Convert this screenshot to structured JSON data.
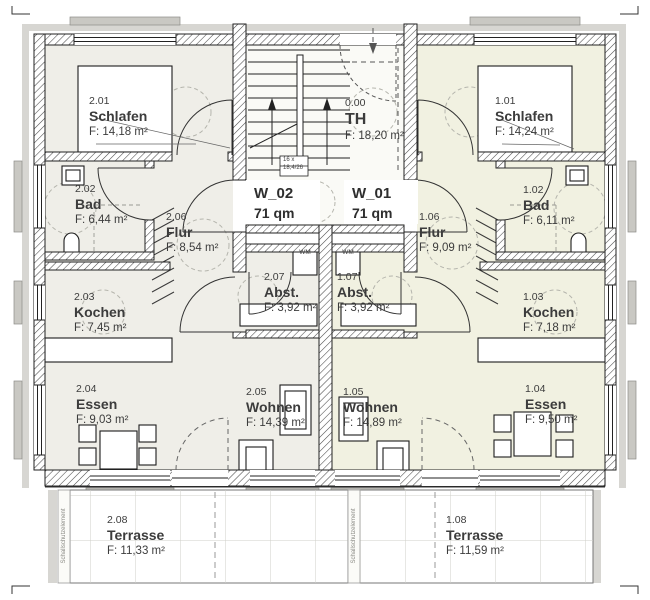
{
  "plan_type": "floor-plan",
  "apartments": {
    "w02": {
      "name": "W_02",
      "size": "71 qm"
    },
    "w01": {
      "name": "W_01",
      "size": "71 qm"
    }
  },
  "stairwell": {
    "number": "0.00",
    "name": "TH",
    "area": "F: 18,20 m²",
    "note1": "16 x",
    "note2": "18,4/26"
  },
  "rooms": {
    "r201": {
      "number": "2.01",
      "name": "Schlafen",
      "area": "F: 14,18 m²"
    },
    "r202": {
      "number": "2.02",
      "name": "Bad",
      "area": "F: 6,44 m²"
    },
    "r203": {
      "number": "2.03",
      "name": "Kochen",
      "area": "F: 7,45 m²"
    },
    "r204": {
      "number": "2.04",
      "name": "Essen",
      "area": "F: 9,03 m²"
    },
    "r205": {
      "number": "2.05",
      "name": "Wohnen",
      "area": "F: 14,39 m²"
    },
    "r206": {
      "number": "2.06",
      "name": "Flur",
      "area": "F: 8,54 m²"
    },
    "r207": {
      "number": "2.07",
      "name": "Abst.",
      "area": "F: 3,92 m²"
    },
    "r208": {
      "number": "2.08",
      "name": "Terrasse",
      "area": "F: 11,33 m²"
    },
    "r101": {
      "number": "1.01",
      "name": "Schlafen",
      "area": "F: 14,24 m²"
    },
    "r102": {
      "number": "1.02",
      "name": "Bad",
      "area": "F: 6,11 m²"
    },
    "r103": {
      "number": "1.03",
      "name": "Kochen",
      "area": "F: 7,18 m²"
    },
    "r104": {
      "number": "1.04",
      "name": "Essen",
      "area": "F: 9,50 m²"
    },
    "r105": {
      "number": "1.05",
      "name": "Wohnen",
      "area": "F: 14,89 m²"
    },
    "r106": {
      "number": "1.06",
      "name": "Flur",
      "area": "F: 9,09 m²"
    },
    "r107": {
      "number": "1.07",
      "name": "Abst.",
      "area": "F: 3,92 m²"
    },
    "r108": {
      "number": "1.08",
      "name": "Terrasse",
      "area": "F: 11,59 m²"
    }
  },
  "annotations": {
    "wm": "WM",
    "sound_wall": "Schallschutzelement"
  },
  "colors": {
    "apartment_left_fill": "#efeee8",
    "apartment_right_fill": "#f1f1e1",
    "stairwell_fill": "#fafaf6",
    "insulation_gray": "#d7d6d2",
    "wall_line": "#2b2b2b",
    "dashed_circle": "#b5b5ad",
    "text": "#3c3c3c"
  }
}
